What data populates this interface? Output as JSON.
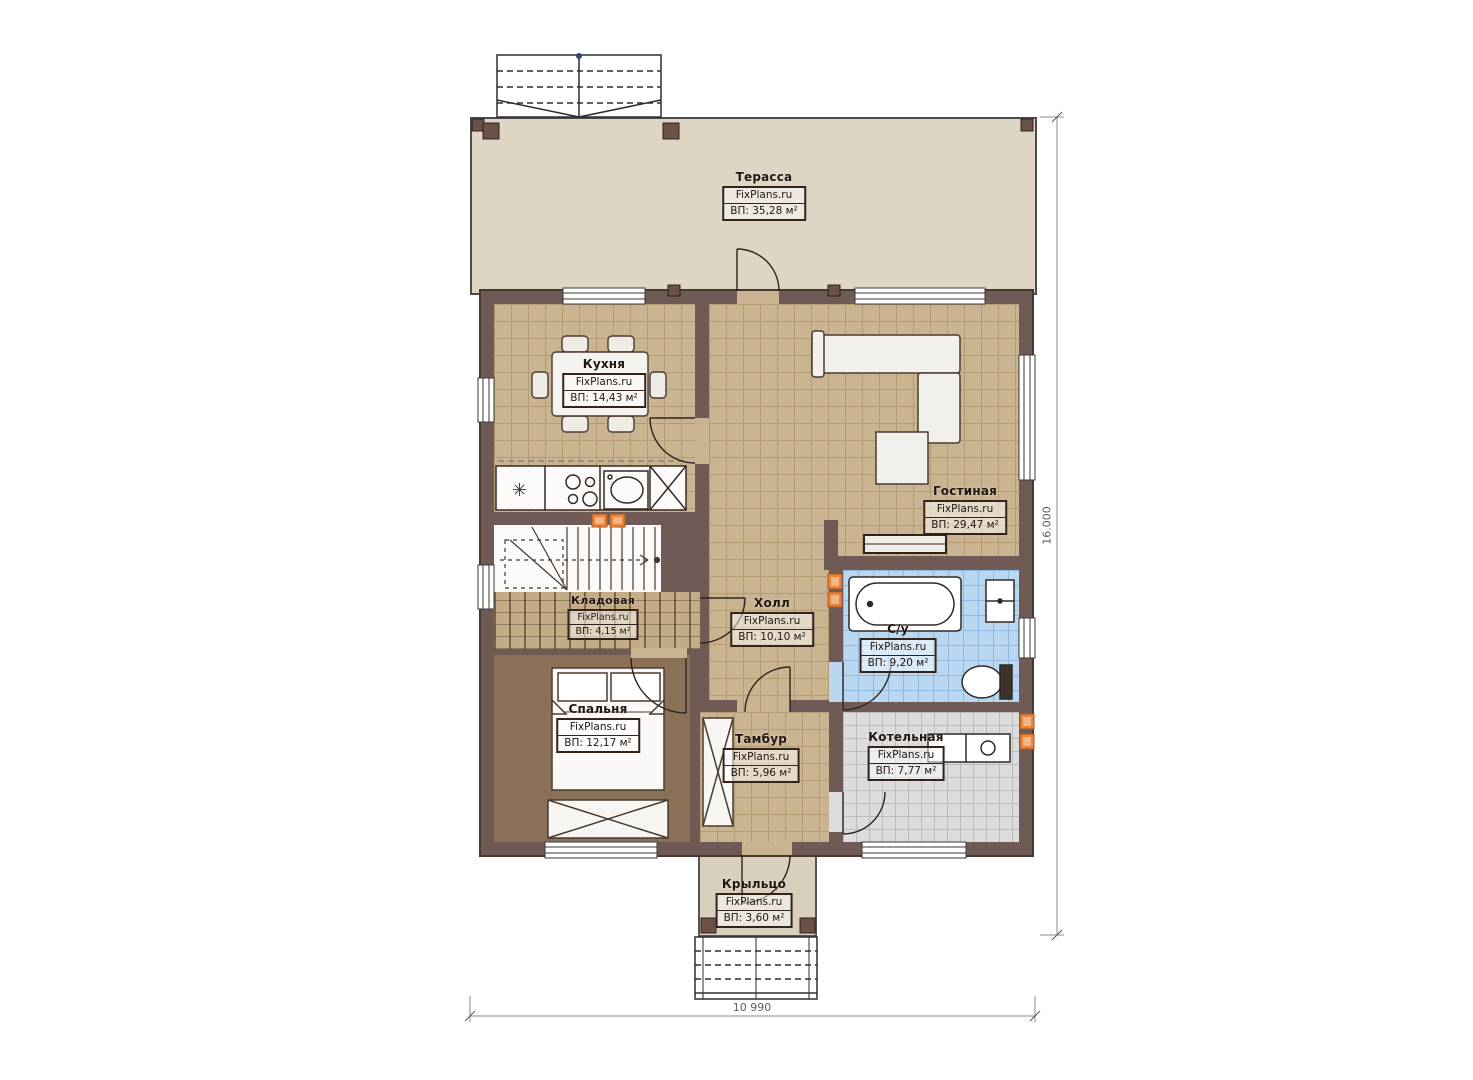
{
  "site_watermark": "FixPlans.ru",
  "rooms": [
    {
      "id": "terrace",
      "name": "Терасса",
      "site": "FixPlans.ru",
      "area": "ВП: 35,28 м²"
    },
    {
      "id": "kitchen",
      "name": "Кухня",
      "site": "FixPlans.ru",
      "area": "ВП: 14,43 м²"
    },
    {
      "id": "living",
      "name": "Гостиная",
      "site": "FixPlans.ru",
      "area": "ВП: 29,47 м²"
    },
    {
      "id": "hall",
      "name": "Холл",
      "site": "FixPlans.ru",
      "area": "ВП: 10,10 м²"
    },
    {
      "id": "pantry",
      "name": "Кладовая",
      "site": "FixPlans.ru",
      "area": "ВП: 4,15 м²"
    },
    {
      "id": "bedroom",
      "name": "Спальня",
      "site": "FixPlans.ru",
      "area": "ВП: 12,17 м²"
    },
    {
      "id": "bathroom",
      "name": "С/у",
      "site": "FixPlans.ru",
      "area": "ВП: 9,20 м²"
    },
    {
      "id": "vestibule",
      "name": "Тамбур",
      "site": "FixPlans.ru",
      "area": "ВП: 5,96 м²"
    },
    {
      "id": "boiler",
      "name": "Котельная",
      "site": "FixPlans.ru",
      "area": "ВП: 7,77 м²"
    },
    {
      "id": "porch",
      "name": "Крыльцо",
      "site": "FixPlans.ru",
      "area": "ВП: 3,60 м²"
    }
  ],
  "dimensions": {
    "height_label": "16.000",
    "width_label": "10 990"
  },
  "colors": {
    "wall": "#6f5a55",
    "tile_tan": "#cab391",
    "tile_blue": "#b9d7f1",
    "tile_grey": "#dcdcdc",
    "floor_bedroom": "#8b7158",
    "terrace": "#ded5c3",
    "vent_marker": "#e8823d"
  }
}
